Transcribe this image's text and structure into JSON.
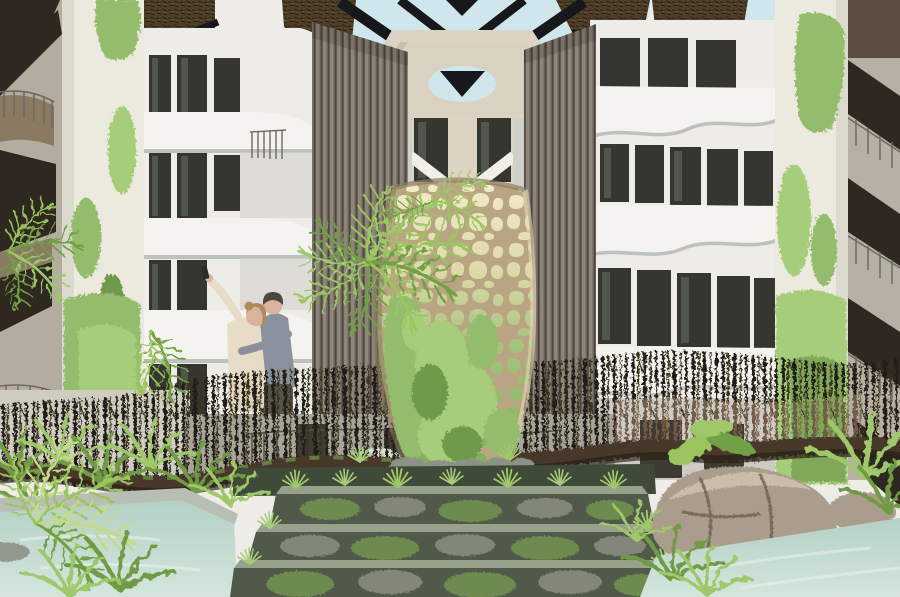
{
  "scene": {
    "label": "Tropical eco-resort atrium interior rendering",
    "elements": [
      {
        "name": "skylight",
        "desc": "pale blue sky through geometric dark timber roof frame"
      },
      {
        "name": "thatch-roof-panels",
        "desc": "dark woven thatch roof sections"
      },
      {
        "name": "porthole-wall",
        "desc": "white octagonal wall element with oval opening"
      },
      {
        "name": "left-building",
        "desc": "white building, dark windows, curved balcony bands"
      },
      {
        "name": "right-building",
        "desc": "white building with scalloped balcony fronts"
      },
      {
        "name": "louver-screens",
        "desc": "two tall vertical wood-slat screens"
      },
      {
        "name": "moss-columns",
        "desc": "white round columns streaked with green moss"
      },
      {
        "name": "voronoi-sculpture",
        "desc": "tan lattice vase tower overgrown with moss"
      },
      {
        "name": "palm-trees",
        "desc": "tropical palms and ferns"
      },
      {
        "name": "bridge",
        "desc": "organic branch-railing bridge with wavy log beam"
      },
      {
        "name": "selfie-couple",
        "desc": "two people embracing, taking a selfie on the bridge"
      },
      {
        "name": "stone-steps",
        "desc": "three moss-covered stone steps"
      },
      {
        "name": "pools",
        "desc": "pale green water pools left and right"
      },
      {
        "name": "boulders",
        "desc": "large rounded rocks at lower right"
      },
      {
        "name": "side-staircases",
        "desc": "dark wooden stairs at far left and far right"
      }
    ]
  },
  "palette": {
    "sky": "#cfe7ec",
    "roofDark": "#16181c",
    "thatch": "#4e3d27",
    "thatchDark": "#2b2115",
    "wallWhite": "#edece7",
    "wallShade": "#d2d0ca",
    "wallWarm": "#ddd3c2",
    "windowDark": "#34362f",
    "windowLight": "#51564d",
    "balconyWhite": "#f4f3ef",
    "balconyShadow": "#bfc1bc",
    "column": "#eceade",
    "moss": "#93bd6c",
    "mossBright": "#a5cd7a",
    "mossDark": "#6f9a4c",
    "louver": "#8d847a",
    "louverDark": "#6a6259",
    "louverGap": "#48423b",
    "sculptureWeb": "#b9a583",
    "sculptureShade": "#8d7c60",
    "sculptureLight": "#e6d8b4",
    "stone": "#8d9287",
    "pebble": "#d8dcd2",
    "water": "#c6ddd3",
    "waterDeep": "#aecdc2",
    "rock": "#ab9d8b",
    "rockDark": "#5f584c",
    "rockLight": "#d2c6b2",
    "stepTop": "#97a18c",
    "stepFace": "#515a4a",
    "stepMoss": "#6d8a4f",
    "fern": "#6f9a45",
    "fernLight": "#9ec86a",
    "palm": "#9cc45f",
    "palmDark": "#71a044",
    "branchDark": "#221c13",
    "branchMid": "#39301f",
    "branchLight": "#77624a",
    "branchLight2": "#8f7656",
    "beam": "#46392c",
    "beamDark": "#251e15",
    "skin": "#d9b49b",
    "hair": "#b08a5e",
    "shirtBeige": "#e6dcc8",
    "shirtGray": "#8b919c",
    "pantsDark": "#57524a",
    "beanie": "#4c473f",
    "stairWood": "#8a7a62",
    "stairDark": "#2e2820",
    "railMetal": "#6f6a61",
    "groundShade": "#a9a49a",
    "doorDark": "#3f3b33",
    "planterDark": "#3f4a38"
  }
}
